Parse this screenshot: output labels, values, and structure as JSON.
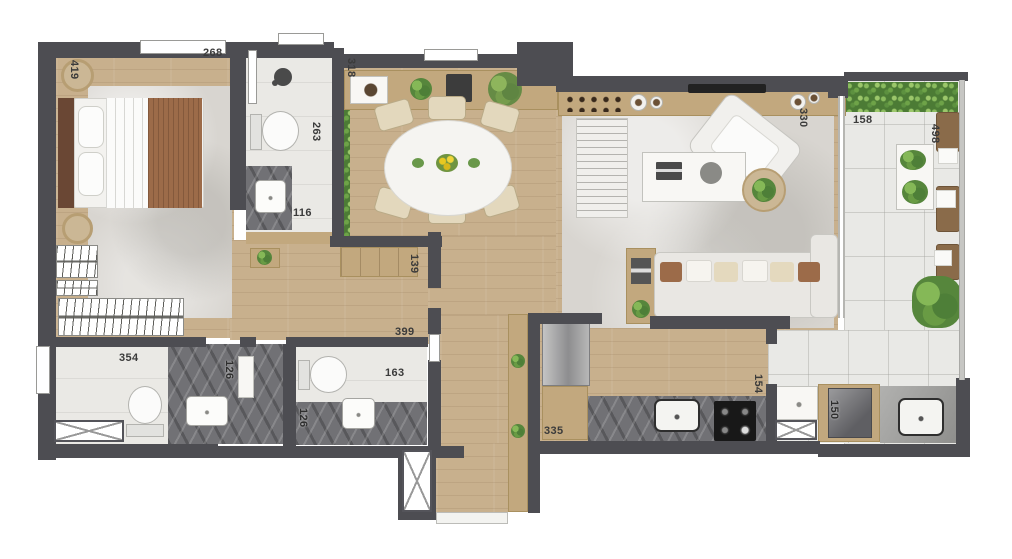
{
  "plan_title": "apartment-floor-plan",
  "palette": {
    "wall": "#4d4d52",
    "wood": "#c8b08d",
    "tile": "#eae9e5",
    "btile": "#e9e9e6",
    "marble": "#717175",
    "plant": "#56863c",
    "rug": "#d8d5d0",
    "tan": "#c2a87e",
    "cream": "#e3d8bd",
    "brown": "#9c6b49",
    "label": "#3b3b3b"
  },
  "labels": {
    "bedroom_width": "419",
    "bedroom_length": "268",
    "bath1_length": "263",
    "bath1_width": "116",
    "dining_width": "318",
    "hall_width": "139",
    "hall_length": "399",
    "bath2_width": "354",
    "bath2_counter": "126",
    "wc_counter": "126",
    "wc_width": "163",
    "living_width": "330",
    "balcony_width": "158",
    "balcony_length": "498",
    "kitchen_width": "335",
    "kitchen_depth": "154",
    "laundry_width": "150"
  },
  "fixtures": [
    "double-bed",
    "wardrobe-hanger-rack",
    "shower-head",
    "toilet",
    "washbasin",
    "oval-dining-table",
    "dining-chair",
    "sideboard",
    "planter",
    "tv",
    "sofa",
    "armchair",
    "coffee-table",
    "refrigerator",
    "cooktop",
    "kitchen-sink",
    "washing-machine",
    "laundry-sink",
    "lounge-chair",
    "hedge",
    "potted-plant",
    "duct-shaft"
  ]
}
